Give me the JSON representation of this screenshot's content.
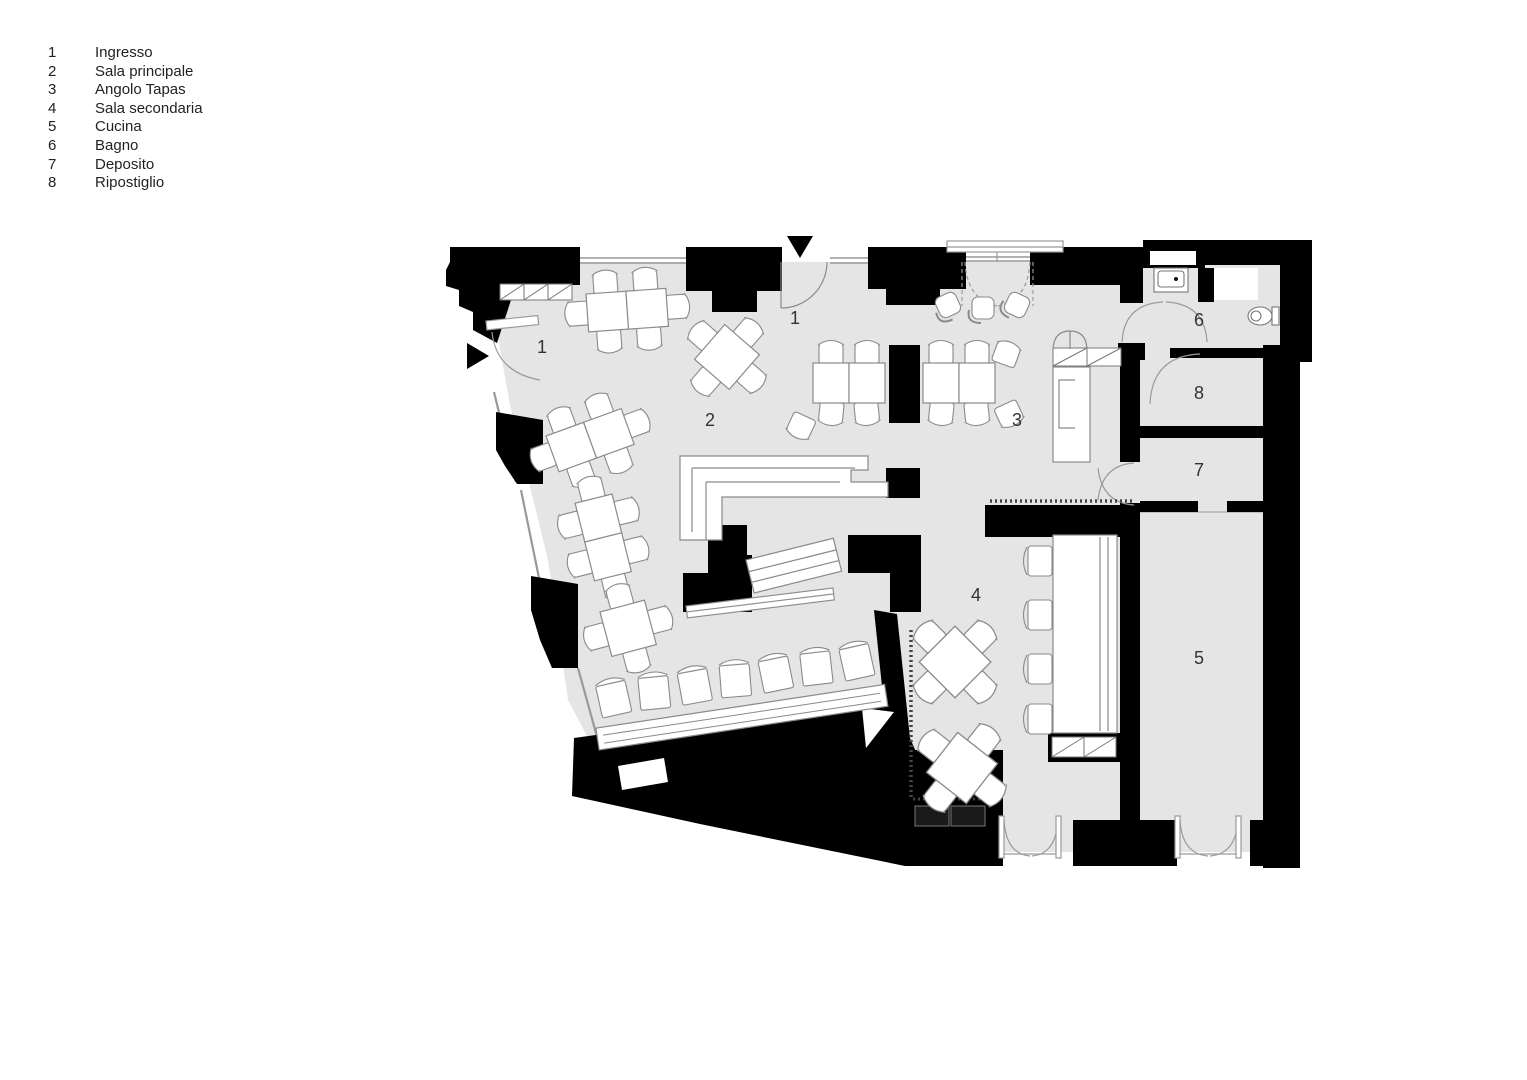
{
  "legend": {
    "items": [
      {
        "num": "1",
        "label": "Ingresso"
      },
      {
        "num": "2",
        "label": "Sala principale"
      },
      {
        "num": "3",
        "label": "Angolo Tapas"
      },
      {
        "num": "4",
        "label": "Sala secondaria"
      },
      {
        "num": "5",
        "label": "Cucina"
      },
      {
        "num": "6",
        "label": "Bagno"
      },
      {
        "num": "7",
        "label": "Deposito"
      },
      {
        "num": "8",
        "label": "Ripostiglio"
      }
    ]
  },
  "plan": {
    "room_labels": [
      {
        "id": "ingresso-left",
        "text": "1"
      },
      {
        "id": "ingresso-top",
        "text": "1"
      },
      {
        "id": "sala-principale",
        "text": "2"
      },
      {
        "id": "angolo-tapas",
        "text": "3"
      },
      {
        "id": "sala-secondaria",
        "text": "4"
      },
      {
        "id": "cucina",
        "text": "5"
      },
      {
        "id": "bagno",
        "text": "6"
      },
      {
        "id": "deposito",
        "text": "7"
      },
      {
        "id": "ripostiglio",
        "text": "8"
      }
    ],
    "colors": {
      "wall": "#000000",
      "floor": "#e5e5e5",
      "furniture_outline": "#8a8a8a",
      "background": "#ffffff"
    }
  }
}
